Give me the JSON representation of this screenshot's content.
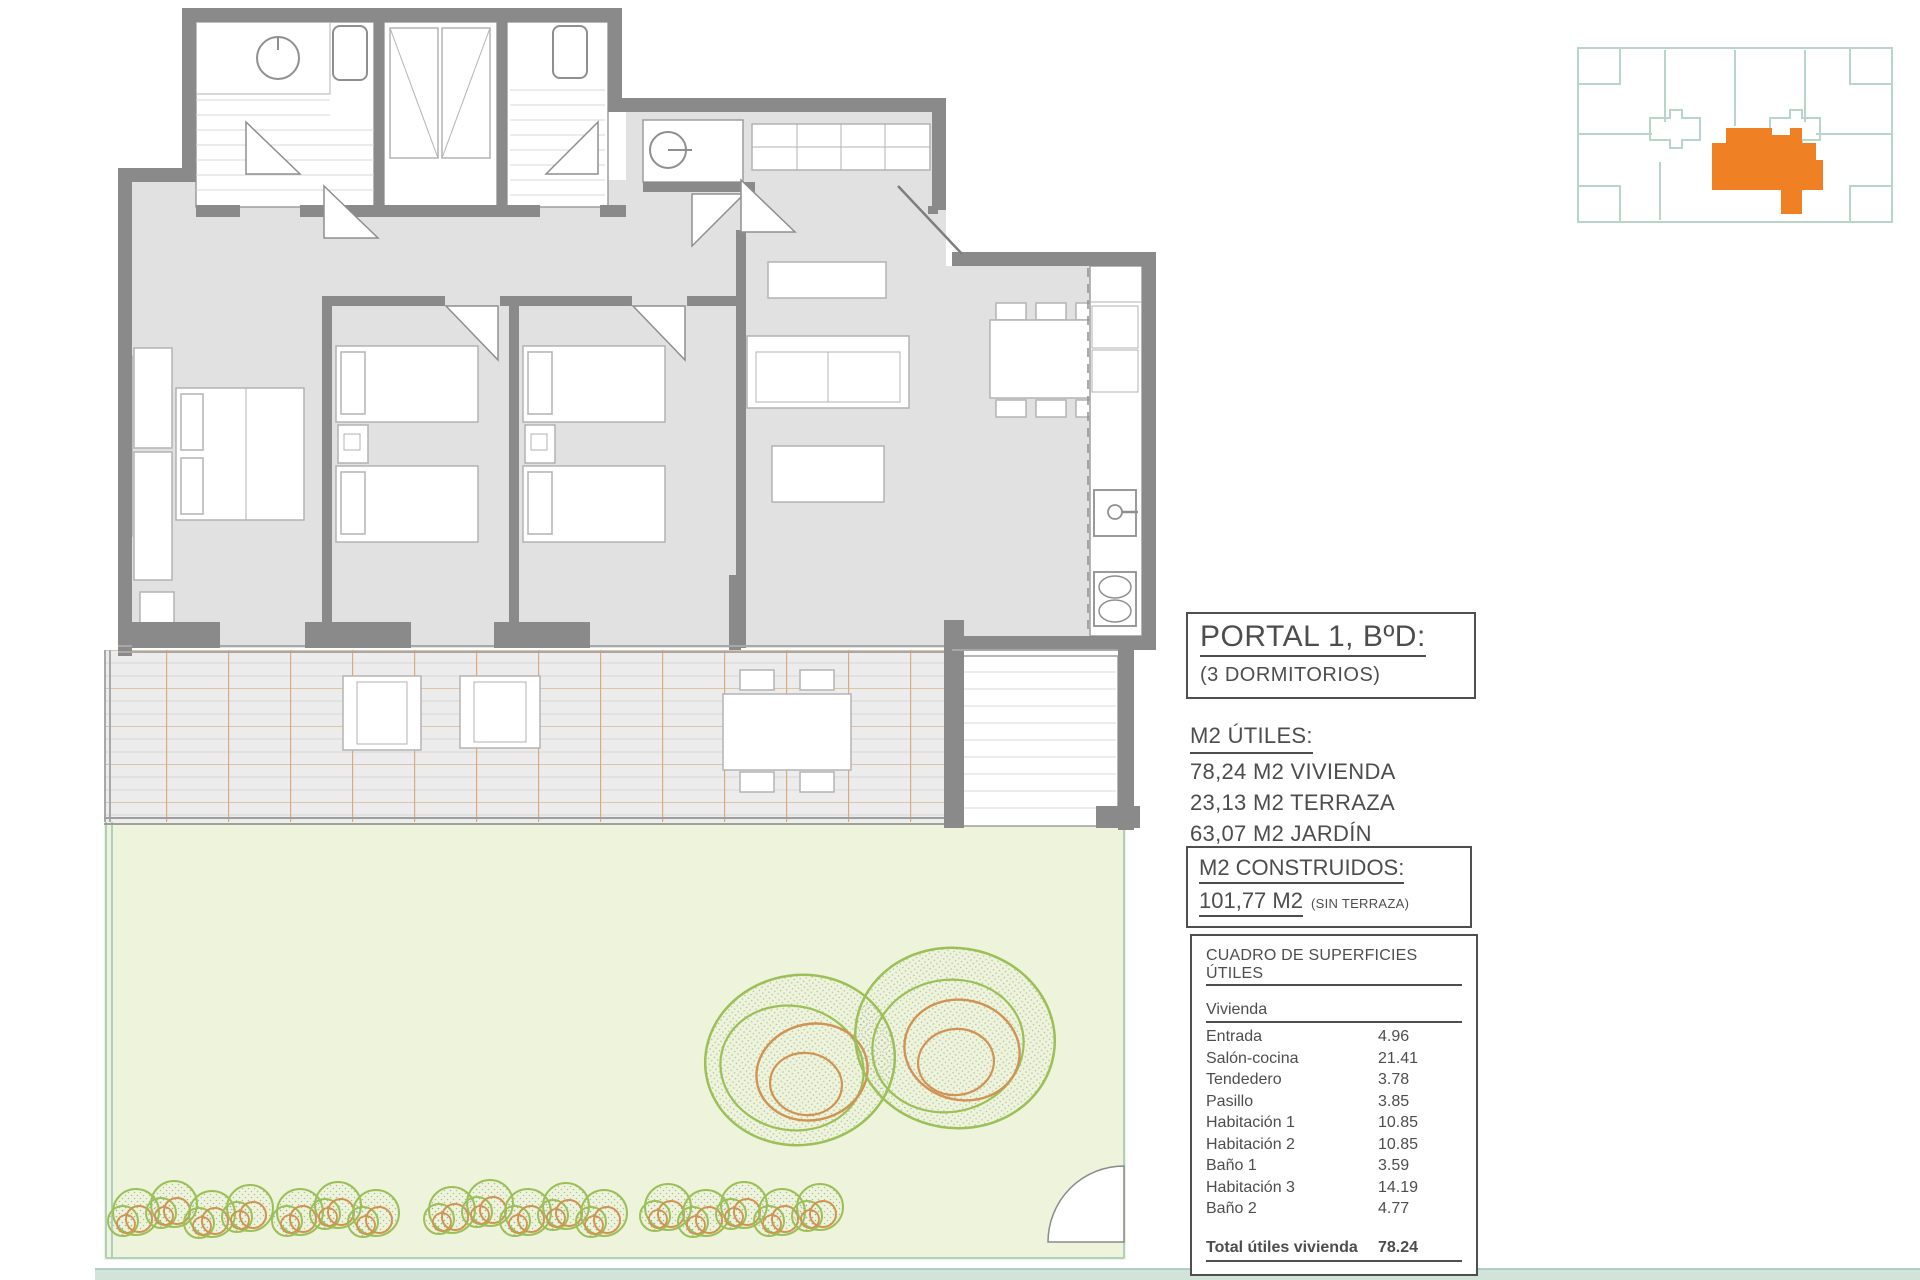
{
  "colors": {
    "ink": "#4d4d4d",
    "wall": "#8a8a8a",
    "floor": "#e1e1e1",
    "terrace": "#ececec",
    "terrace-line": "#d9ab7e",
    "garden": "#eef4dc",
    "fence": "#a9cabb",
    "tree-green": "#9cbf57",
    "tree-orange": "#cf9353",
    "accent": "#ef8023",
    "keyplan": "#b7d6c7"
  },
  "panel": {
    "portal": {
      "title": "PORTAL 1, BºD:",
      "subtitle": "(3 DORMITORIOS)"
    },
    "utiles": {
      "heading": "M2 ÚTILES:",
      "lines": [
        "78,24 M2 VIVIENDA",
        "23,13 M2 TERRAZA",
        "63,07 M2 JARDÍN"
      ]
    },
    "construidos": {
      "heading": "M2 CONSTRUIDOS:",
      "value": "101,77 M2",
      "note": "(SIN TERRAZA)"
    },
    "table": {
      "title": "CUADRO DE SUPERFICIES ÚTILES",
      "group": "Vivienda",
      "rows": [
        {
          "label": "Entrada",
          "value": "4.96"
        },
        {
          "label": "Salón-cocina",
          "value": "21.41"
        },
        {
          "label": "Tendedero",
          "value": "3.78"
        },
        {
          "label": "Pasillo",
          "value": "3.85"
        },
        {
          "label": "Habitación 1",
          "value": "10.85"
        },
        {
          "label": "Habitación 2",
          "value": "10.85"
        },
        {
          "label": "Baño 1",
          "value": "3.59"
        },
        {
          "label": "Habitación 3",
          "value": "14.19"
        },
        {
          "label": "Baño 2",
          "value": "4.77"
        }
      ],
      "total": {
        "label": "Total útiles vivienda",
        "value": "78.24"
      }
    }
  }
}
